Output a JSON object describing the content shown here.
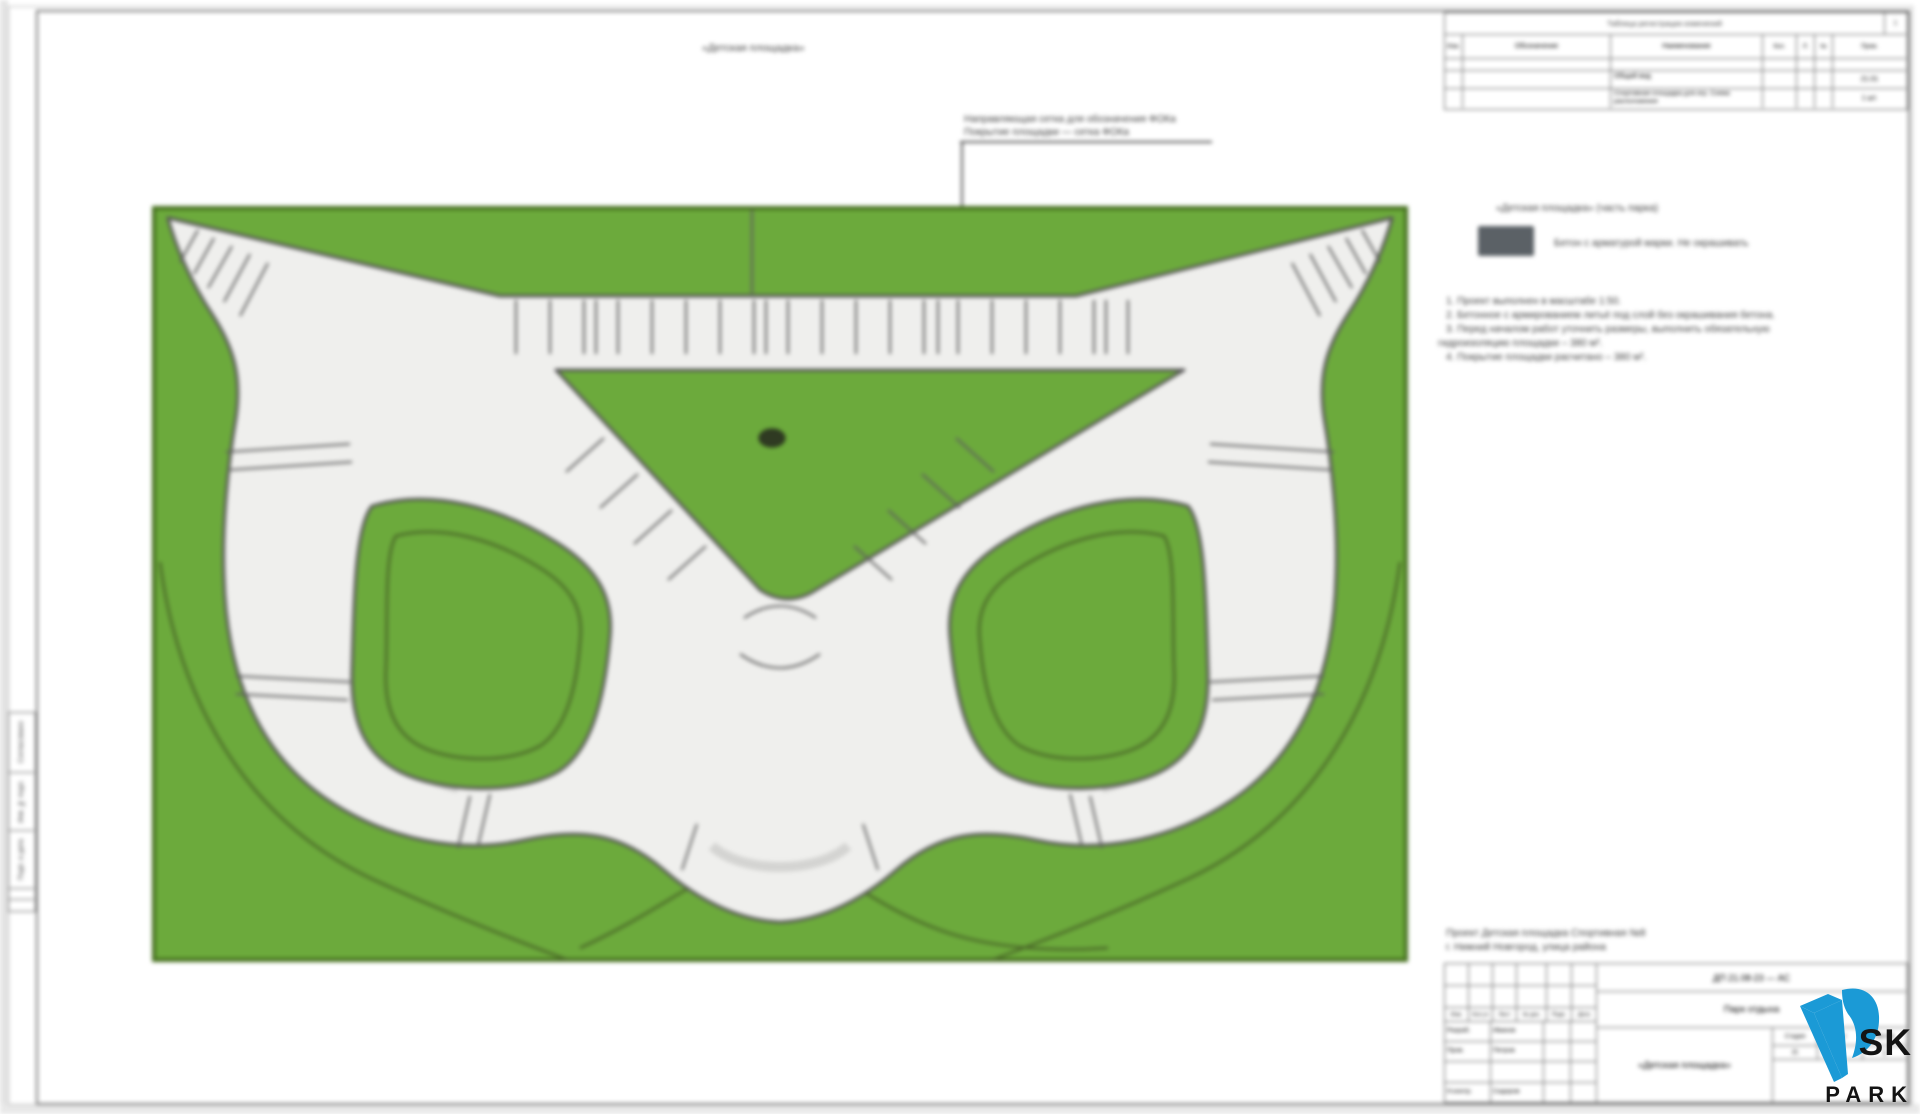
{
  "sheet": {
    "top_title": "«Детская площадка»"
  },
  "annotation": {
    "line1": "Направляющая сетка для обозначения ФОКа",
    "line2": "Покрытие площадки — сетка ФОКа"
  },
  "revision_table": {
    "title": "Таблица регистрации изменений",
    "corner": "1",
    "columns": [
      "Изм.",
      "Обозначение",
      "Наименование",
      "Кол.",
      "Л.",
      "№",
      "Прим."
    ],
    "rows": [
      [
        "",
        "",
        "",
        "",
        "",
        "",
        ""
      ],
      [
        "",
        "",
        "Общий вид",
        "",
        "",
        "",
        "21.01"
      ],
      [
        "",
        "",
        "Спортивная площадка для игр. Схема расположения",
        "",
        "",
        "",
        "1 шт."
      ]
    ]
  },
  "legend": {
    "title": "«Детская площадка» (часть парка)",
    "swatch_color": "#5b6166",
    "swatch_label": "Бетон с арматурой марки. Не окрашивать"
  },
  "notes": [
    "1. Проект выполнен в масштабе 1:50.",
    "2. Бетонное с армированием литьё под слой без окрашивания бетона.",
    "3. Перед началом работ уточнить размеры, выполнить обязательную",
    "гидроизоляцию площадки – 380 м².",
    "4. Покрытие площадки расчитано – 380 м²."
  ],
  "above_stamp": {
    "line1": "Проект Детская площадка Спортивная №8",
    "line2": "г. Нижний Новгород, улица района"
  },
  "stamp": {
    "mini_headers": [
      "Изм.",
      "Кол.уч",
      "Лист",
      "№ док.",
      "Подп.",
      "Дата"
    ],
    "left_rows": [
      {
        "role": "Разраб.",
        "name": "Иванов"
      },
      {
        "role": "Пров.",
        "name": "Петров"
      },
      {
        "role": "",
        "name": ""
      },
      {
        "role": "Н.контр.",
        "name": "Сидоров"
      }
    ],
    "code": "ДП 21.08-23 — АС",
    "project": "Парк отдыха",
    "title_cell": "«Детская площадка»",
    "stage_headers": [
      "Стадия",
      "Лист",
      "Листов"
    ],
    "stage_values": [
      "П",
      "1",
      "1"
    ]
  },
  "side_stamp": {
    "labels": [
      "Согласовано",
      "Инв. № подл.",
      "Подп. и дата"
    ]
  },
  "logo": {
    "sk": "SK",
    "park": "PARK",
    "blue": "#1b9ad6"
  },
  "plan": {
    "field_color": "#6CAA3C",
    "field_border": "#456F1E",
    "track_color": "#EFEFED",
    "outline_color": "#565656",
    "marker_color": "#2F3A22"
  }
}
